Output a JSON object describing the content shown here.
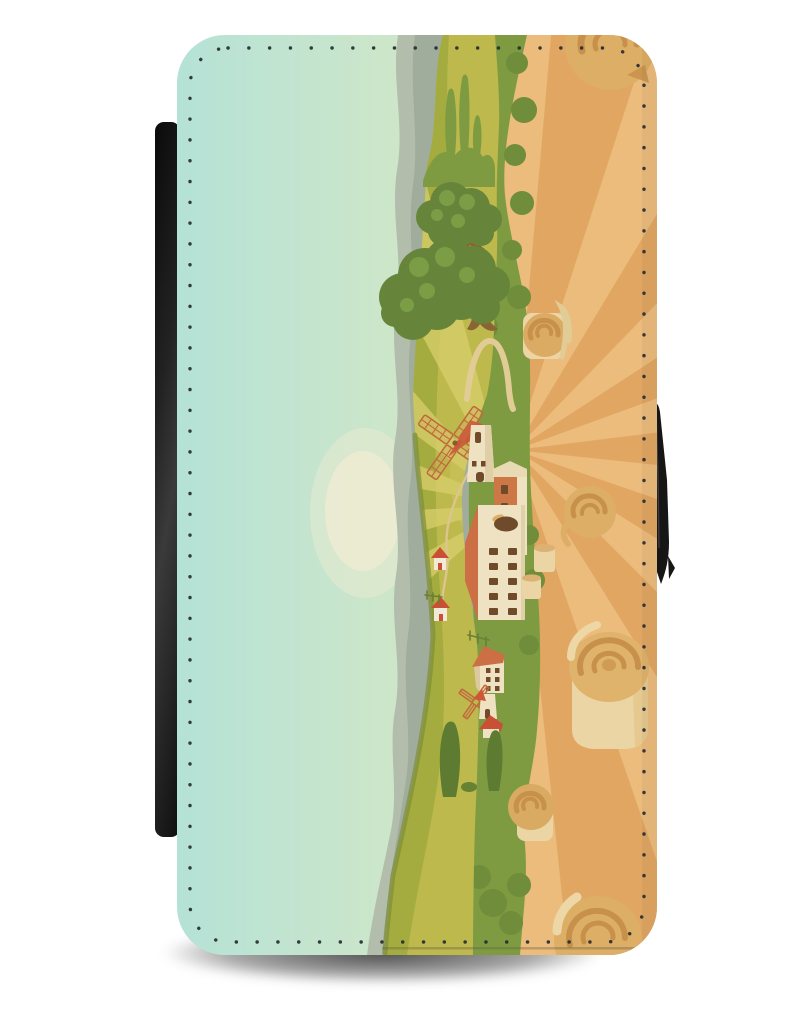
{
  "product": {
    "name": "Flip Wallet Phone Case",
    "design_theme": "Cartoon farm countryside print with windmill, farmhouse and hay field",
    "view": "Front cover closed; flip spine visible at left edge; magnetic clasp at right edge; studio white background with drop shadow",
    "scene_elements": [
      "sky",
      "sun haze",
      "mountains",
      "rolling green hills",
      "trees",
      "cypress trees",
      "windmill",
      "farmhouse",
      "tall barn",
      "village houses",
      "hillside huts",
      "fences",
      "hay field with sun rays",
      "hay bales",
      "stitched border"
    ]
  },
  "colors": {
    "sky_left": "#b5e2d7",
    "sky_mid1": "#cde6c9",
    "sky_mid2": "#dfe6bf",
    "sky_right": "#e6e3ab",
    "sun_haze": "#edebd2",
    "mountain_light": "#b3bdac",
    "mountain_dark": "#a0ac9c",
    "hill_base": "#bdb94d",
    "ridge_olive": "#a2ab3e",
    "hill_streak": "#d6ce69",
    "hill_rim": "#7d8f35",
    "meadow": "#7e9b41",
    "bush": "#6f8d3a",
    "tree_foliage": "#66853a",
    "tree_highlight": "#7da047",
    "trunk": "#8a6434",
    "cypress": "#5d7c31",
    "field_light": "#ecbc7c",
    "field_ray": "#e0a45e",
    "bale_light": "#ecd5a4",
    "bale_mid": "#dcae66",
    "bale_dark": "#c8914b",
    "wall_cream": "#efe2c2",
    "wall_shade": "#dcc9a0",
    "roof_terracotta": "#cd6f45",
    "roof_red": "#ce5639",
    "window_brown": "#6f4b2c",
    "hut_red": "#c94f35",
    "fence": "#6b7f35",
    "path_tan": "#dcc691",
    "swirl": "#e2cc96",
    "blade": "#bf6a3a",
    "stitch": "#262b33",
    "spine_dark": "#0a0a0a",
    "spine_light": "#3a3a3a",
    "clasp": "#161616"
  }
}
